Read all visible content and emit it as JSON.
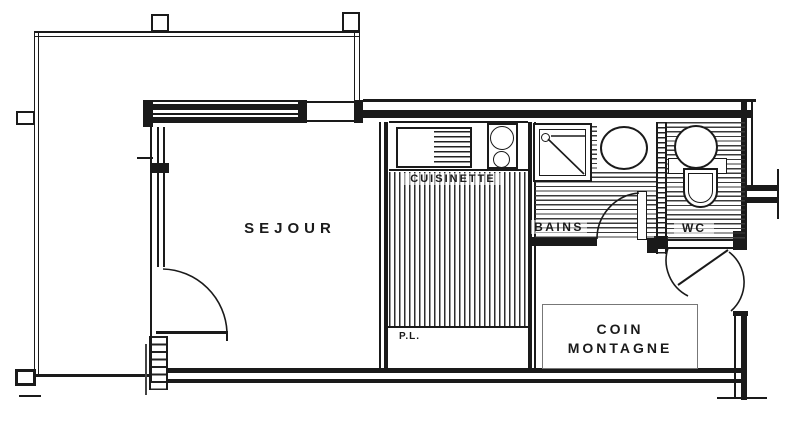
{
  "page": {
    "type": "scanned apartment floor plan",
    "width_px": 800,
    "height_px": 427
  },
  "colors": {
    "background": "#ffffff",
    "ink": "#1a1a1a",
    "light_gray": "#8c8c8c"
  },
  "rooms": {
    "sejour": {
      "label": "SEJOUR"
    },
    "cuisinette": {
      "label": "CUISINETTE"
    },
    "bains": {
      "label": "BAINS"
    },
    "wc": {
      "label": "WC"
    },
    "placard": {
      "label": "P.L."
    },
    "coin_montagne": {
      "label_line1": "COIN",
      "label_line2": "MONTAGNE"
    }
  },
  "fixtures": {
    "kitchen_sink": "kitchen-sink-with-drainer",
    "cooktop": "two-burner-cooktop",
    "shower": "shower-tray-with-drain",
    "washbasin": "oval-washbasin",
    "toilet": "toilet-with-round-cistern",
    "bed": "coin-montagne-sleeping-area",
    "balcony": "balcony-terrace-railing",
    "doors": "door-swing-arcs"
  }
}
